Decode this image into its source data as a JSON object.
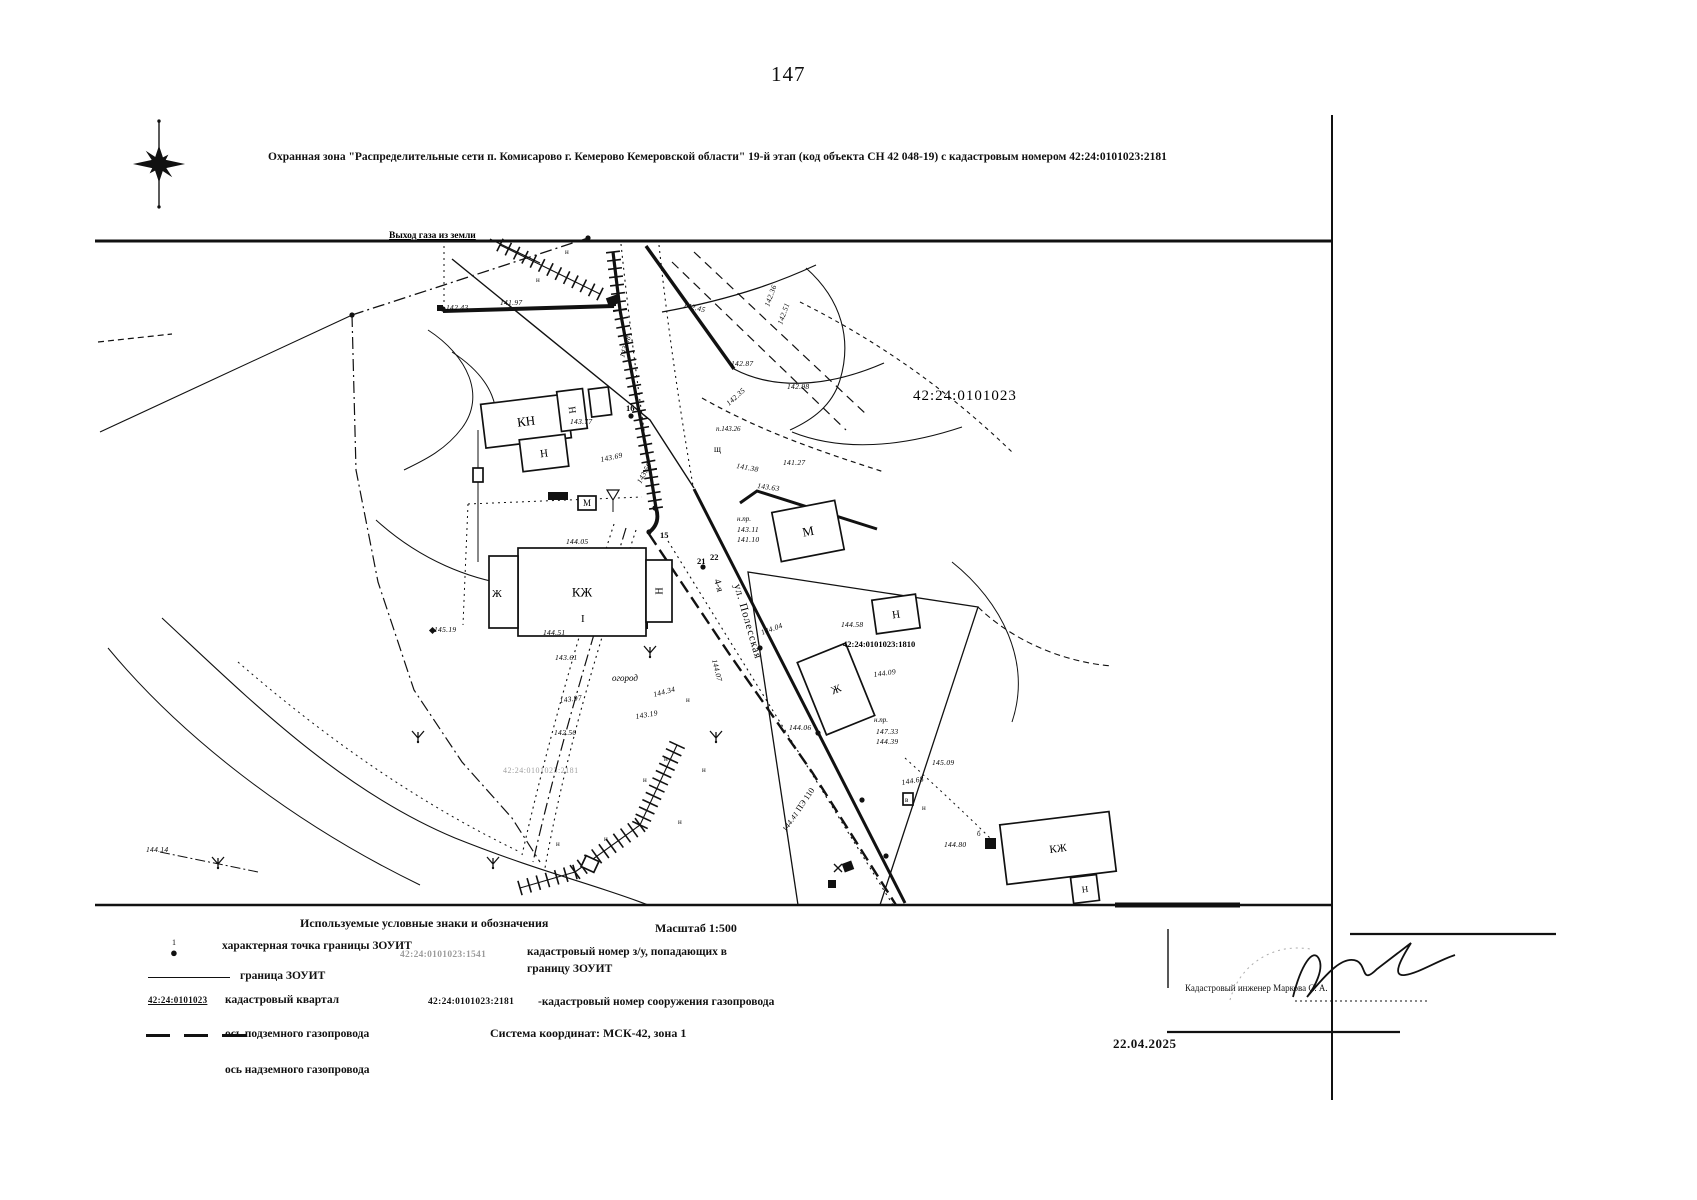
{
  "page": {
    "number": "147",
    "title": "Охранная зона \"Распределительные сети п. Комисарово г. Кемерово Кемеровской области\" 19-й этап (код объекта СН 42 048-19) с кадастровым номером 42:24:0101023:2181"
  },
  "map": {
    "quarter_number": "42:24:0101023",
    "gas_exit_label": "Выход газа из земли",
    "street_prefix": "4-я",
    "street_name": "ул. Полесская",
    "garden_label": "огород",
    "parcel_number": "42:24:0101023:1810",
    "faint_parcel_number": "42:24:0101023:2181",
    "pipe_type_label": "ПЭ 110",
    "buildings": [
      {
        "label": "КН",
        "x": 483,
        "y": 399,
        "w": 86,
        "h": 44,
        "r": -7,
        "fs": 13
      },
      {
        "label": "Н",
        "x": 559,
        "y": 390,
        "w": 26,
        "h": 40,
        "r": -7,
        "fs": 10,
        "lr": -90
      },
      {
        "label": "",
        "x": 590,
        "y": 388,
        "w": 20,
        "h": 28,
        "r": -7
      },
      {
        "label": "Н",
        "x": 521,
        "y": 437,
        "w": 46,
        "h": 32,
        "r": -7,
        "fs": 11
      },
      {
        "label": "КЖ",
        "x": 518,
        "y": 548,
        "w": 128,
        "h": 88,
        "r": 0,
        "fs": 13
      },
      {
        "label": "Н",
        "x": 646,
        "y": 560,
        "w": 26,
        "h": 62,
        "r": 0,
        "fs": 10,
        "lr": -90
      },
      {
        "label": "",
        "x": 489,
        "y": 556,
        "w": 29,
        "h": 72,
        "r": 0
      },
      {
        "label": "М",
        "x": 776,
        "y": 506,
        "w": 64,
        "h": 50,
        "r": -11,
        "fs": 13
      },
      {
        "label": "Н",
        "x": 874,
        "y": 597,
        "w": 44,
        "h": 34,
        "r": -8,
        "fs": 11
      },
      {
        "label": "Ж",
        "x": 810,
        "y": 650,
        "w": 52,
        "h": 78,
        "r": -22,
        "fs": 11
      },
      {
        "label": "КЖ",
        "x": 1003,
        "y": 818,
        "w": 110,
        "h": 60,
        "r": -7,
        "fs": 11
      },
      {
        "label": "Н",
        "x": 1072,
        "y": 876,
        "w": 26,
        "h": 26,
        "r": -7,
        "fs": 9
      },
      {
        "label": "М",
        "x": 578,
        "y": 496,
        "w": 18,
        "h": 14,
        "r": 0,
        "fs": 9
      },
      {
        "label": "",
        "x": 903,
        "y": 793,
        "w": 10,
        "h": 12,
        "r": 0
      },
      {
        "label": "",
        "x": 583,
        "y": 858,
        "w": 14,
        "h": 12,
        "r": 25
      },
      {
        "label": "",
        "x": 473,
        "y": 468,
        "w": 10,
        "h": 14,
        "r": 0
      }
    ],
    "elevations": [
      {
        "t": "142.43",
        "x": 446,
        "y": 310
      },
      {
        "t": "141.97",
        "x": 500,
        "y": 305
      },
      {
        "t": "142.45",
        "x": 683,
        "y": 307,
        "r": 14
      },
      {
        "t": "142.87",
        "x": 731,
        "y": 366
      },
      {
        "t": "142.98",
        "x": 787,
        "y": 389
      },
      {
        "t": "142.35",
        "x": 729,
        "y": 406,
        "r": -42
      },
      {
        "t": "143.08",
        "x": 624,
        "y": 358,
        "r": -72
      },
      {
        "t": "142.36",
        "x": 769,
        "y": 307,
        "r": -70
      },
      {
        "t": "142.51",
        "x": 782,
        "y": 325,
        "r": -70
      },
      {
        "t": "143.77",
        "x": 570,
        "y": 424
      },
      {
        "t": "143.69",
        "x": 601,
        "y": 462,
        "r": -12
      },
      {
        "t": "143.56",
        "x": 641,
        "y": 484,
        "r": -62
      },
      {
        "t": "144.05",
        "x": 566,
        "y": 544
      },
      {
        "t": "143.63",
        "x": 757,
        "y": 488,
        "r": 8
      },
      {
        "t": "141.38",
        "x": 736,
        "y": 468,
        "r": 10
      },
      {
        "t": "141.27",
        "x": 783,
        "y": 465
      },
      {
        "t": "144.58",
        "x": 841,
        "y": 627
      },
      {
        "t": "144.09",
        "x": 874,
        "y": 677,
        "r": -8
      },
      {
        "t": "147.33",
        "x": 876,
        "y": 734
      },
      {
        "t": "144.39",
        "x": 876,
        "y": 744
      },
      {
        "t": "144.51",
        "x": 543,
        "y": 635
      },
      {
        "t": "143.61",
        "x": 555,
        "y": 660
      },
      {
        "t": "145.19",
        "x": 434,
        "y": 632
      },
      {
        "t": "143.97",
        "x": 560,
        "y": 703,
        "r": -8
      },
      {
        "t": "142.50",
        "x": 554,
        "y": 735
      },
      {
        "t": "143.19",
        "x": 636,
        "y": 719,
        "r": -10
      },
      {
        "t": "144.34",
        "x": 654,
        "y": 697,
        "r": -15
      },
      {
        "t": "144.04",
        "x": 762,
        "y": 635,
        "r": -20
      },
      {
        "t": "144.06",
        "x": 789,
        "y": 730
      },
      {
        "t": "144.41",
        "x": 786,
        "y": 832,
        "r": -55
      },
      {
        "t": "144.80",
        "x": 944,
        "y": 847
      },
      {
        "t": "145.09",
        "x": 932,
        "y": 765
      },
      {
        "t": "144.68",
        "x": 902,
        "y": 785,
        "r": -10
      },
      {
        "t": "144.14",
        "x": 146,
        "y": 852
      },
      {
        "t": "144.07",
        "x": 712,
        "y": 660,
        "r": 76
      },
      {
        "t": "143.11",
        "x": 737,
        "y": 532
      },
      {
        "t": "141.10",
        "x": 737,
        "y": 542
      }
    ],
    "texts": [
      {
        "t": "42:24:0101023",
        "x": 913,
        "y": 400,
        "s": 15,
        "ls": 1
      },
      {
        "t": "Выход газа из земли",
        "x": 389,
        "y": 238,
        "s": 9.5,
        "b": 1,
        "u": 1
      },
      {
        "t": "42:24:0101023:1810",
        "x": 843,
        "y": 647,
        "s": 8.5,
        "b": 1
      },
      {
        "t": "42:24:0101023:2181",
        "x": 503,
        "y": 773,
        "s": 8,
        "o": 0.38,
        "ls": 0.5
      },
      {
        "t": "огород",
        "x": 612,
        "y": 681,
        "s": 9,
        "i": 1
      },
      {
        "t": "4-я",
        "x": 714,
        "y": 580,
        "s": 10,
        "r": 74
      },
      {
        "t": "ул. Полесская",
        "x": 734,
        "y": 585,
        "s": 11,
        "r": 74,
        "ls": 1
      },
      {
        "t": "ПЭ 110",
        "x": 800,
        "y": 812,
        "s": 8.5,
        "r": -56
      },
      {
        "t": "щ",
        "x": 714,
        "y": 452,
        "s": 9
      },
      {
        "t": "п.143.26",
        "x": 716,
        "y": 431,
        "s": 7,
        "i": 1
      },
      {
        "t": "н.пр.",
        "x": 737,
        "y": 521,
        "s": 7,
        "i": 1
      },
      {
        "t": "н.пр.",
        "x": 874,
        "y": 722,
        "s": 7,
        "i": 1
      },
      {
        "t": "16",
        "x": 626,
        "y": 411,
        "s": 8.5,
        "b": 1
      },
      {
        "t": "15",
        "x": 660,
        "y": 538,
        "s": 8.5,
        "b": 1
      },
      {
        "t": "22",
        "x": 710,
        "y": 560,
        "s": 8.5,
        "b": 1
      },
      {
        "t": "21",
        "x": 697,
        "y": 564,
        "s": 8.5,
        "b": 1
      },
      {
        "t": "Ж",
        "x": 492,
        "y": 597,
        "s": 11
      },
      {
        "t": "I",
        "x": 581,
        "y": 622,
        "s": 11
      },
      {
        "t": "в",
        "x": 905,
        "y": 802,
        "s": 7
      },
      {
        "t": "б",
        "x": 977,
        "y": 836,
        "s": 7
      },
      {
        "t": "н",
        "x": 536,
        "y": 282,
        "s": 7
      },
      {
        "t": "н",
        "x": 565,
        "y": 254,
        "s": 7
      },
      {
        "t": "н",
        "x": 556,
        "y": 846,
        "s": 7
      },
      {
        "t": "н",
        "x": 604,
        "y": 841,
        "s": 7
      },
      {
        "t": "н",
        "x": 664,
        "y": 761,
        "s": 7
      },
      {
        "t": "н",
        "x": 686,
        "y": 702,
        "s": 7
      },
      {
        "t": "н",
        "x": 702,
        "y": 772,
        "s": 7
      },
      {
        "t": "н",
        "x": 643,
        "y": 782,
        "s": 7
      },
      {
        "t": "н",
        "x": 678,
        "y": 824,
        "s": 7
      },
      {
        "t": "н",
        "x": 922,
        "y": 810,
        "s": 7
      }
    ]
  },
  "legend": {
    "header": "Используемые условные знаки и обозначения",
    "scale": "Масштаб 1:500",
    "items": [
      {
        "label": "характерная точка границы ЗОУИТ"
      },
      {
        "label": "граница ЗОУИТ"
      },
      {
        "label": "кадастровый квартал",
        "symbol_text": "42:24:0101023"
      },
      {
        "label": "ось подземного газопровода"
      },
      {
        "label": "ось надземного газопровода"
      }
    ],
    "right": {
      "parcel_ref_number": "42:24:0101023:1541",
      "parcel_ref_label": "кадастровый номер з/у, попадающих в границу ЗОУИТ",
      "pipeline_ref_number": "42:24:0101023:2181",
      "pipeline_ref_label": "-кадастровый номер сооружения газопровода",
      "coordinate_system": "Система координат: МСК-42, зона 1"
    }
  },
  "footer": {
    "engineer_label": "Кадастровый инженер  Маркова С. А.",
    "date": "22.04.2025"
  }
}
